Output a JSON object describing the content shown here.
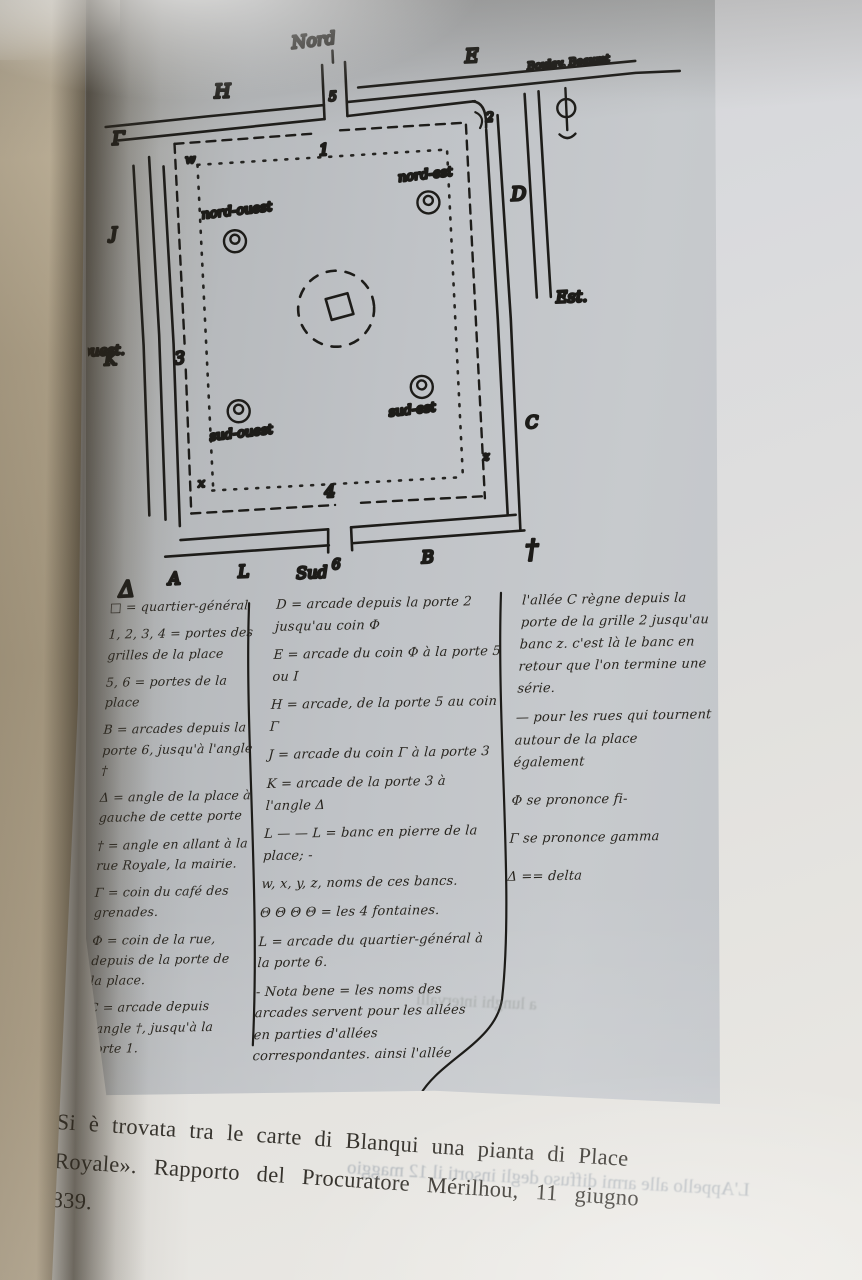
{
  "figure": {
    "map": {
      "compass_north": "Nord",
      "compass_south": "Sud",
      "compass_east": "Est.",
      "compass_west": "ouest.",
      "street_label": "Boulev. Beaumt",
      "arcade_H": "H",
      "arcade_E": "E",
      "arcade_D": "D",
      "arcade_C": "C",
      "arcade_B": "B",
      "arcade_L": "L",
      "arcade_A": "A",
      "arcade_K": "K",
      "arcade_J": "J",
      "corner_gamma": "Γ",
      "corner_delta": "Δ",
      "corner_cross": "†",
      "gate_1": "1",
      "gate_2": "2",
      "gate_3": "3",
      "gate_4": "4",
      "gate_5": "5",
      "gate_6": "6",
      "bench_nw": "w",
      "bench_sw": "x",
      "bench_se": "z",
      "fountain_nw": "nord-ouest",
      "fountain_ne": "nord-est",
      "fountain_sw": "sud-ouest",
      "fountain_se": "sud-est"
    },
    "legend": {
      "col1": [
        "□ = quartier-général",
        "1, 2, 3, 4 = portes des grilles de la place",
        "5, 6 = portes de la place",
        "B = arcades depuis la porte 6, jusqu'à l'angle †",
        "Δ = angle de la place à gauche de cette porte",
        "† = angle en allant à la rue Royale, la mairie.",
        "Γ = coin du café des grenades.",
        "Φ = coin de la rue, depuis de la porte de la place.",
        "C = arcade depuis l'angle †, jusqu'à la porte 1."
      ],
      "col2": [
        "D = arcade depuis la porte 2 jusqu'au coin Φ",
        "E = arcade du coin Φ à la porte 5 ou I",
        "H = arcade, de la porte 5 au coin Γ",
        "J = arcade du coin Γ à la porte 3",
        "K = arcade de la porte 3 à l'angle Δ",
        "L — — L = banc en pierre de la place; -",
        "w, x, y, z, noms de ces bancs.",
        "Θ Θ Θ Θ = les 4 fontaines.",
        "L = arcade du quartier-général à la porte 6.",
        "- Nota bene = les noms des arcades servent pour les allées en parties d'allées correspondantes. ainsi l'allée"
      ],
      "col3": [
        "l'allée C règne depuis la porte de la grille 2 jusqu'au banc z. c'est là le banc en retour que l'on termine une série.",
        "— pour les rues qui tournent autour de la place également",
        "Φ se prononce fi-",
        "Γ se prononce gamma",
        "Δ == delta"
      ]
    },
    "bleed_through": {
      "inside_figure": "a lunghi intervalli",
      "below_caption": "L'Appello alle armi diffuso degli insorti il 12 maggio"
    }
  },
  "caption": {
    "line1": "Si è trovata tra le carte di Blanqui una pianta di Place",
    "line2": "Royale». Rapporto del Procuratore Mérilhou, 11 giugno",
    "line3": "839."
  },
  "colors": {
    "page": "#e2e1de",
    "facsimile_gray": "#c0c3c7",
    "ink": "#1d1c19",
    "book_edge": "#b1a389",
    "gutter_shadow": "#2a2318"
  }
}
